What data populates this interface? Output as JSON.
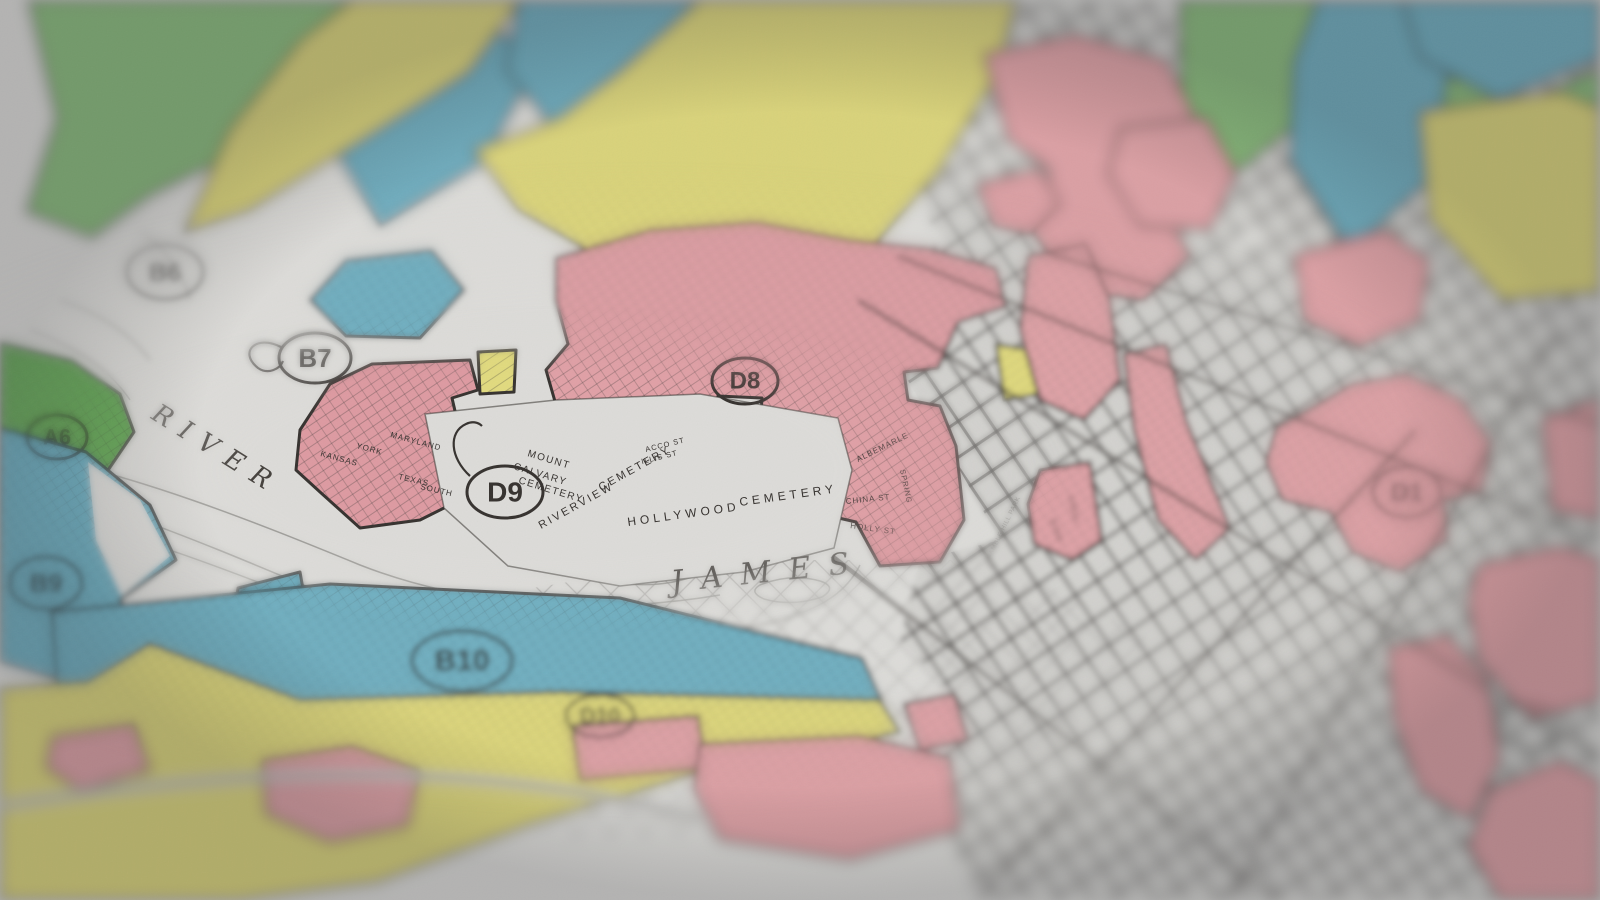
{
  "image_type": "photograph of a paper residential-security (redlining) map, shallow depth of field, focus on center-left band",
  "map": {
    "palette": {
      "paper": "#dcdbd8",
      "ink": "#35312e",
      "grid_base": "#d2d1ce",
      "grade_A_green": "#8cbe7e",
      "grade_A_green_dark": "#6cad5d",
      "grade_B_blue": "#72b2c4",
      "grade_C_yellow": "#e1da7e",
      "grade_D_pink": "#e2a4a9",
      "river_line": "#85837f"
    },
    "district_markers": [
      {
        "id": "A6",
        "x": 57,
        "y": 437,
        "rx": 30,
        "ry": 22,
        "fs": 22
      },
      {
        "id": "B6",
        "x": 165,
        "y": 272,
        "rx": 38,
        "ry": 27,
        "fs": 26
      },
      {
        "id": "B7",
        "x": 315,
        "y": 358,
        "rx": 36,
        "ry": 25,
        "fs": 26,
        "leader": "M281,347 C256,334 238,352 258,368 C268,375 280,369 283,361"
      },
      {
        "id": "B9",
        "x": 46,
        "y": 583,
        "rx": 36,
        "ry": 26,
        "fs": 26
      },
      {
        "id": "B10",
        "x": 462,
        "y": 661,
        "rx": 50,
        "ry": 30,
        "fs": 30
      },
      {
        "id": "D10",
        "x": 600,
        "y": 716,
        "rx": 34,
        "ry": 21,
        "fs": 22
      },
      {
        "id": "D9",
        "x": 505,
        "y": 492,
        "rx": 38,
        "ry": 26,
        "fs": 28,
        "leader": "M470,476 C450,458 448,432 466,424 C472,421 478,422 482,426"
      },
      {
        "id": "D8",
        "x": 745,
        "y": 381,
        "rx": 33,
        "ry": 23,
        "fs": 24
      },
      {
        "id": "D1",
        "x": 1407,
        "y": 492,
        "rx": 34,
        "ry": 25,
        "fs": 26
      },
      {
        "id": "",
        "x": 1528,
        "y": 727,
        "rx": 30,
        "ry": 22,
        "fs": 20
      }
    ],
    "place_labels": [
      {
        "t": "RIVER",
        "x": 150,
        "y": 418,
        "r": 32,
        "s": 26,
        "ls": 12,
        "f": "serif"
      },
      {
        "t": "JAMES",
        "x": 672,
        "y": 592,
        "r": -6,
        "s": 30,
        "ls": 18,
        "f": "serif"
      },
      {
        "t": "MOUNT",
        "x": 527,
        "y": 456,
        "r": 17,
        "s": 10,
        "ls": 1.5
      },
      {
        "t": "CALVARY",
        "x": 513,
        "y": 469,
        "r": 17,
        "s": 10,
        "ls": 1.5
      },
      {
        "t": "CEMETERY",
        "x": 518,
        "y": 483,
        "r": 17,
        "s": 10,
        "ls": 1.5
      },
      {
        "t": "RIVERVIEW",
        "x": 541,
        "y": 529,
        "r": -29,
        "s": 11,
        "ls": 2.5
      },
      {
        "t": "CEMETERY",
        "x": 601,
        "y": 491,
        "r": -29,
        "s": 11,
        "ls": 2.5
      },
      {
        "t": "HOLLYWOOD",
        "x": 628,
        "y": 526,
        "r": -8,
        "s": 12,
        "ls": 4
      },
      {
        "t": "CEMETERY",
        "x": 740,
        "y": 506,
        "r": -8,
        "s": 12,
        "ls": 4
      },
      {
        "t": "ACCO ST",
        "x": 646,
        "y": 452,
        "r": -14,
        "s": 7.5,
        "ls": 1
      },
      {
        "t": "ILLIS ST",
        "x": 642,
        "y": 464,
        "r": -14,
        "s": 7.5,
        "ls": 1
      },
      {
        "t": "GAMBLE HILL PARK",
        "x": 990,
        "y": 560,
        "r": -64,
        "s": 6.5,
        "ls": 0.5
      },
      {
        "t": "CANAL",
        "x": 1068,
        "y": 496,
        "r": 76,
        "s": 7.5,
        "ls": 1
      },
      {
        "t": "BYRD",
        "x": 1050,
        "y": 520,
        "r": 70,
        "s": 7.5,
        "ls": 1
      },
      {
        "t": "MARYLAND",
        "x": 390,
        "y": 437,
        "r": 15,
        "s": 8,
        "ls": 1
      },
      {
        "t": "YORK",
        "x": 356,
        "y": 448,
        "r": 15,
        "s": 8,
        "ls": 1
      },
      {
        "t": "KANSAS",
        "x": 320,
        "y": 456,
        "r": 15,
        "s": 8,
        "ls": 1
      },
      {
        "t": "TEXAS",
        "x": 398,
        "y": 479,
        "r": 13,
        "s": 8,
        "ls": 1
      },
      {
        "t": "SOUTH",
        "x": 420,
        "y": 489,
        "r": 13,
        "s": 8,
        "ls": 1
      },
      {
        "t": "ALBEMARLE",
        "x": 858,
        "y": 462,
        "r": -26,
        "s": 8,
        "ls": 1
      },
      {
        "t": "SPRING",
        "x": 900,
        "y": 470,
        "r": 78,
        "s": 7.5,
        "ls": 1
      },
      {
        "t": "CHINA ST",
        "x": 846,
        "y": 504,
        "r": -6,
        "s": 8,
        "ls": 1
      },
      {
        "t": "HOLLY ST",
        "x": 850,
        "y": 528,
        "r": 8,
        "s": 8,
        "ls": 1
      }
    ],
    "zones": [
      {
        "grade": "A",
        "pts": "28,0 360,0 332,66 238,152 150,196 92,238 26,212 56,118",
        "hatch": "a"
      },
      {
        "grade": "A",
        "pts": "1180,0 1402,0 1332,96 1238,172 1182,118",
        "hatch": "a"
      },
      {
        "grade": "A",
        "pts": "1422,66 1520,102 1600,70 1600,166 1502,224 1424,178",
        "hatch": "a"
      },
      {
        "grade": "A",
        "fill": "#6cad5d",
        "pts": "0,342 72,360 120,394 134,432 100,482 40,520 0,514",
        "hatch": "ab"
      },
      {
        "grade": "B",
        "pts": "338,54 470,14 542,58 482,164 380,226 330,142",
        "hatch": "ab"
      },
      {
        "grade": "B",
        "pts": "518,0 700,0 682,92 562,140 506,70",
        "hatch": "ab"
      },
      {
        "grade": "B",
        "pts": "310,300 346,260 432,250 464,290 420,338 346,336",
        "hatch": "ab"
      },
      {
        "grade": "B",
        "pts": "0,428 86,452 150,505 176,560 120,600 150,645 86,688 0,662",
        "hatch": "ab"
      },
      {
        "grade": "B",
        "pts": "238,588 300,572 312,640 268,700 222,688",
        "hatch": "ab"
      },
      {
        "grade": "B",
        "pts": "52,612 330,584 620,598 862,658 882,702 558,692 300,702 58,702",
        "hatch": "ab"
      },
      {
        "grade": "B",
        "pts": "1318,0 1422,0 1450,62 1428,182 1350,252 1290,160 1294,62",
        "hatch": "ab"
      },
      {
        "grade": "B",
        "pts": "1402,0 1600,0 1600,58 1500,100 1420,58",
        "hatch": "ab"
      },
      {
        "grade": "B",
        "pts": "1554,148 1600,128 1600,262 1560,252",
        "hatch": "ab"
      },
      {
        "grade": "C",
        "pts": "352,0 520,0 468,72 358,142 250,210 184,232 230,130 300,42",
        "hatch": "ab"
      },
      {
        "grade": "C",
        "pts": "700,0 1016,0 998,72 940,170 868,252 700,262 598,256 518,210 474,150 560,118 622,70",
        "hatch": "ab"
      },
      {
        "grade": "C",
        "pts": "478,352 516,350 514,392 480,394",
        "hatch": "a"
      },
      {
        "grade": "C",
        "pts": "0,688 88,682 150,644 300,700 558,692 880,700 900,732 700,772 538,822 378,882 240,900 0,900",
        "hatch": "ab"
      },
      {
        "grade": "C",
        "pts": "1420,112 1560,92 1600,108 1600,292 1502,300 1430,220",
        "hatch": "ab"
      },
      {
        "grade": "C",
        "pts": "996,344 1030,350 1040,394 1004,400",
        "hatch": "a"
      },
      {
        "grade": "D",
        "pts": "984,54 1076,34 1166,60 1196,120 1160,200 1190,256 1144,300 1076,290 1034,234 1050,170 1008,140",
        "hatch": "ab"
      },
      {
        "grade": "D",
        "pts": "1120,128 1206,118 1236,174 1210,230 1140,226 1108,174",
        "hatch": "ab"
      },
      {
        "grade": "D",
        "pts": "976,184 1040,168 1060,204 1030,234 994,226",
        "hatch": "ab"
      },
      {
        "grade": "D",
        "pts": "1028,256 1086,244 1110,300 1120,380 1084,420 1040,400 1020,330",
        "hatch": "ab"
      },
      {
        "grade": "D",
        "pts": "1124,354 1166,344 1186,420 1230,528 1196,560 1158,520 1134,430",
        "hatch": "ab"
      },
      {
        "grade": "D",
        "pts": "1294,254 1386,230 1430,260 1420,320 1360,346 1304,320",
        "hatch": "ab"
      },
      {
        "grade": "D",
        "fill": "#e0a0a6",
        "pts": "556,258 650,230 756,222 850,240 926,248 996,268 1006,306 958,322 938,368 904,372 908,400 940,406 956,446 964,520 940,562 880,566 856,522 830,516 832,470 798,464 794,430 760,428 762,398 718,396 716,430 688,432 686,408 640,410 636,438 600,440 596,414 558,412 546,370 568,344 556,300",
        "hatch": "ab"
      },
      {
        "grade": "D",
        "fill": "#dd9aa1",
        "pts": "300,430 330,384 372,364 470,360 478,390 452,398 458,424 430,428 438,462 470,458 476,492 420,520 360,528 320,492 296,470",
        "hatch": "ab"
      },
      {
        "grade": "D",
        "pts": "1040,470 1090,462 1102,540 1072,560 1034,544 1028,504",
        "hatch": "ab"
      },
      {
        "grade": "D",
        "pts": "1276,428 1352,384 1406,374 1460,398 1492,444 1482,492 1444,500 1448,540 1400,572 1352,552 1330,512 1282,500 1266,462",
        "hatch": "ab"
      },
      {
        "grade": "D",
        "pts": "1542,418 1600,398 1600,520 1552,510",
        "hatch": "ab"
      },
      {
        "grade": "D",
        "pts": "1478,564 1560,546 1600,558 1600,700 1530,720 1478,660 1468,600",
        "hatch": "ab"
      },
      {
        "grade": "D",
        "pts": "1388,648 1448,634 1488,680 1500,760 1470,820 1420,790 1394,720",
        "hatch": "ab"
      },
      {
        "grade": "D",
        "pts": "1490,790 1560,760 1600,780 1600,900 1500,900 1468,846",
        "hatch": "ab"
      },
      {
        "grade": "D",
        "pts": "572,726 698,716 706,768 580,780",
        "hatch": "ab"
      },
      {
        "grade": "D",
        "pts": "700,744 860,736 950,758 960,830 850,860 720,840 694,790",
        "hatch": "ab"
      },
      {
        "grade": "D",
        "pts": "262,760 352,746 420,770 408,826 330,842 266,814",
        "hatch": "ab"
      },
      {
        "grade": "D",
        "pts": "52,736 134,724 150,770 80,790 46,768",
        "hatch": "ab"
      },
      {
        "grade": "D",
        "pts": "904,704 954,694 968,740 920,750",
        "hatch": "ab"
      }
    ],
    "street_grids": [
      {
        "pts": "830,245 1600,245 1600,900 978,900 930,800 958,700 900,640 920,560 1000,540"
      },
      {
        "pts": "898,0 1282,0 1270,200 1160,330 1018,330 928,220"
      },
      {
        "pts": "1280,0 1600,0 1600,420 1432,430 1300,360 1252,230 1256,90"
      }
    ],
    "arteries": [
      "M858,300 L1600,758",
      "M898,256 L1600,542",
      "M1044,252 L1600,424",
      "M1228,900 L1556,332",
      "M978,900 L1416,430",
      "M832,556 L1276,900"
    ],
    "main_roads": [
      "M0,806 C300,758 520,768 700,820"
    ],
    "river": {
      "rapids_crosshatch": "330,622 700,560 1000,560 1150,640 1048,760 800,832 560,842 400,742",
      "contours": [
        "M0,478 C120,505 230,555 340,600 C480,655 620,655 760,625 C830,610 850,585 860,565",
        "M0,502 C130,530 240,575 350,618 C470,662 610,668 750,640",
        "M20,452 C140,476 250,520 360,565 C470,608 600,615 720,595",
        "M600,560 q40,-18 90,-8 q30,6 10,22 q-40,16 -85,8 q-28,-8 -15,-22 Z",
        "M760,585 q30,-12 60,-4 q18,6 2,16 q-30,10 -58,2 q-16,-7 -4,-14 Z",
        "M60,300 q60,20 90,60",
        "M30,330 q70,25 100,70",
        "M140,230 q40,30 50,70",
        "M636,450 l14,8",
        "M646,446 l-8,14"
      ]
    },
    "white_areas": [
      {
        "pts": "88,462 140,500 170,556 122,596 96,540",
        "outline": false
      },
      {
        "pts": "425,414 556,400 700,394 838,418 852,470 834,548 744,572 620,586 508,566 444,508",
        "outline": true
      }
    ]
  }
}
